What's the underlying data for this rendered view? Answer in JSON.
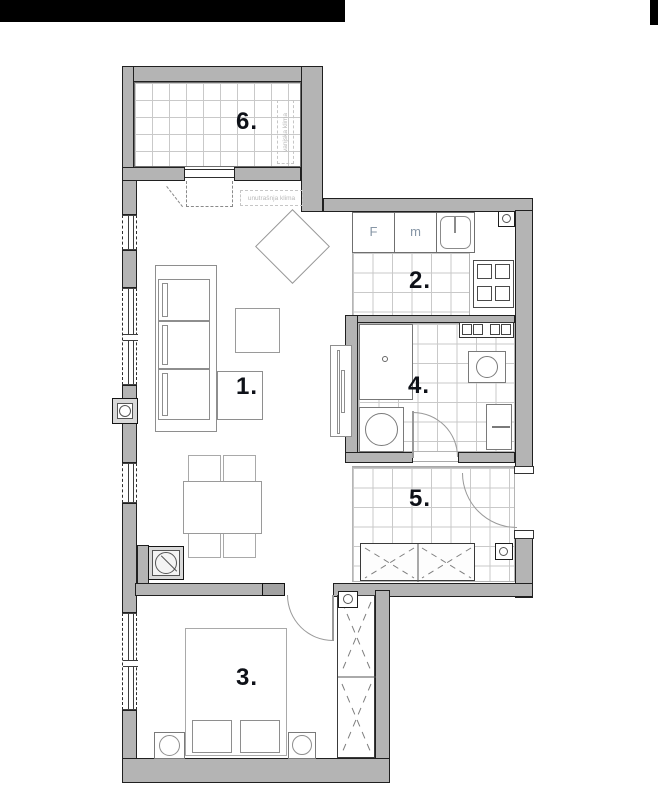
{
  "rooms": [
    {
      "number": "1.",
      "name": "living-room"
    },
    {
      "number": "2.",
      "name": "kitchen"
    },
    {
      "number": "3.",
      "name": "bedroom"
    },
    {
      "number": "4.",
      "name": "bathroom"
    },
    {
      "number": "5.",
      "name": "hallway"
    },
    {
      "number": "6.",
      "name": "balcony"
    }
  ],
  "labels": {
    "outdoor_ac_unit": "vanjska klima",
    "indoor_ac_unit": "unutrašnja klima",
    "fridge": "F",
    "appliance_m": "m"
  },
  "colors": {
    "top_bar": "#000000",
    "wall_fill": "#b4b4b4",
    "wall_outline": "#202020",
    "tile_line": "#c9c9c9",
    "furniture_line": "#8e8e8e",
    "room_number": "#0e1118",
    "ac_label": "#b9b9b9",
    "kitchen_label": "#8796a6"
  }
}
